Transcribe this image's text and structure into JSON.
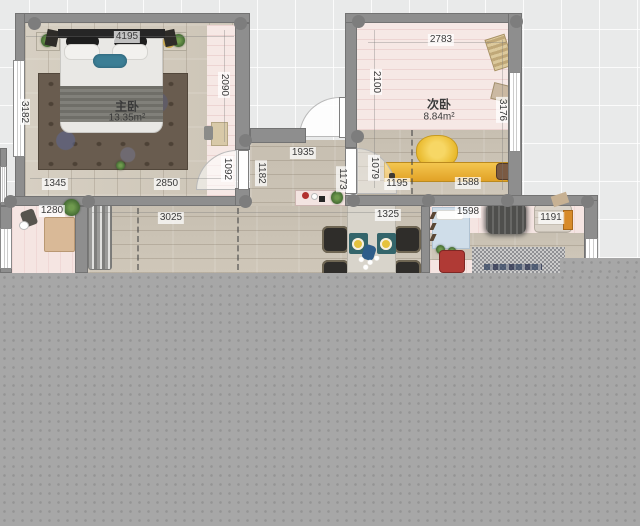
{
  "floorplan": {
    "rooms": {
      "master": {
        "name": "主卧",
        "area": "13.35m²"
      },
      "secondary": {
        "name": "次卧",
        "area": "8.84m²"
      }
    },
    "dimensions": {
      "d4195": "4195",
      "d3182": "3182",
      "d2090": "2090",
      "d1345": "1345",
      "d2850": "2850",
      "d1092": "1092",
      "d1182": "1182",
      "d1935": "1935",
      "d1173": "1173",
      "d1079": "1079",
      "d2100": "2100",
      "d2783": "2783",
      "d3176": "3176",
      "d1195": "1195",
      "d1588": "1588",
      "d1280": "1280",
      "d3025": "3025",
      "d1325": "1325",
      "d1598": "1598",
      "d1191": "1191"
    },
    "colors": {
      "wall": "#8e8e8e",
      "canvas": "#e9eaea",
      "bottom_overlay": "#a7a7a7",
      "wood_floor": "#ccc4b6",
      "pink_floor": "#f6e8e5",
      "accent_yellow": "#efaf2e",
      "accent_teal": "#3c7e95",
      "dining_chair": "#2f2d2a"
    }
  }
}
